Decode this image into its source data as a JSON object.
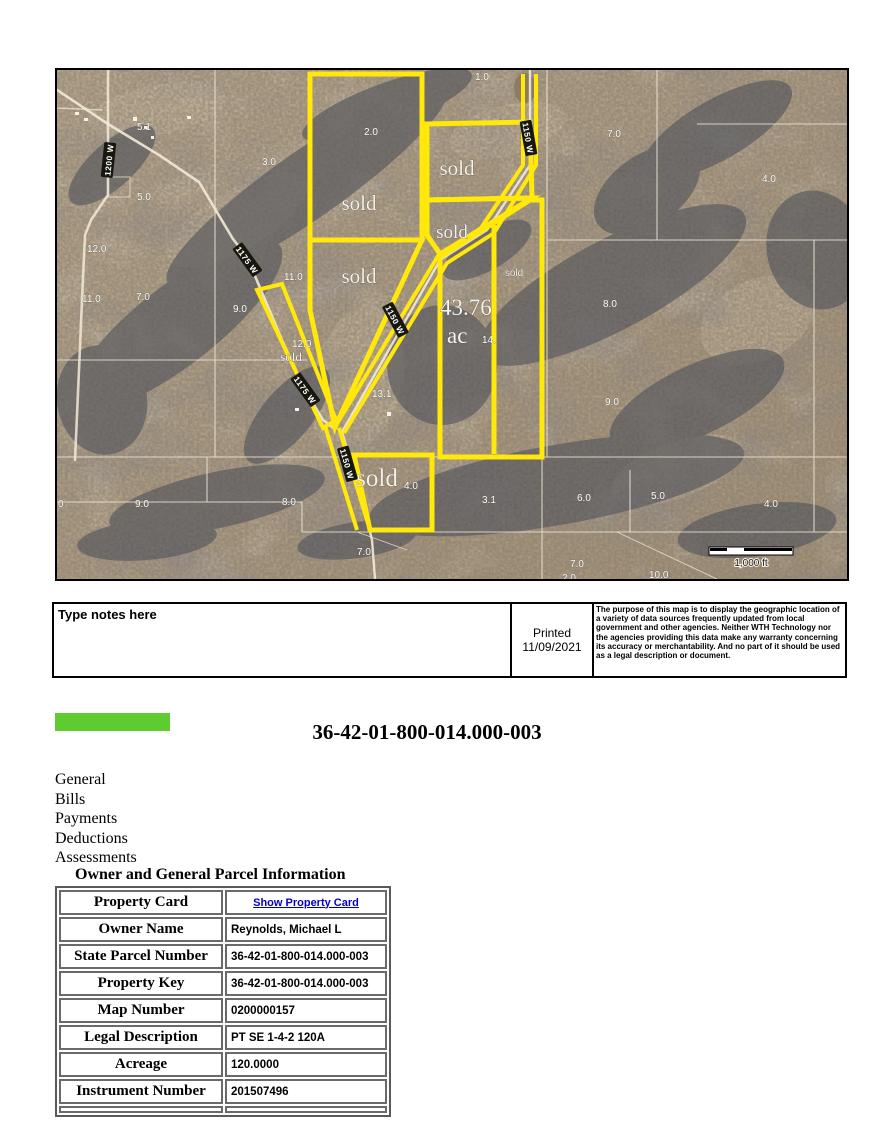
{
  "header": {
    "parcel_title": "36-42-01-800-014.000-003",
    "accent_color": "#5ecb31"
  },
  "notes": {
    "placeholder": "Type notes here",
    "printed_line1": "Printed",
    "printed_line2": "11/09/2021",
    "disclaimer": "The purpose of this map is to display the geographic location of a variety of data sources frequently updated from local government and other agencies. Neither WTH Technology nor the agencies providing this data make any warranty concerning its accuracy or merchantability. And no part of it should be used as a legal description or document."
  },
  "nav": {
    "items": [
      "General",
      "Bills",
      "Payments",
      "Deductions",
      "Assessments"
    ]
  },
  "section": {
    "heading": "Owner and General Parcel Information"
  },
  "parcel_table": {
    "rows": [
      {
        "label": "Property Card",
        "value": "Show Property Card",
        "link": true
      },
      {
        "label": "Owner Name",
        "value": "Reynolds, Michael L"
      },
      {
        "label": "State Parcel Number",
        "value": "36-42-01-800-014.000-003"
      },
      {
        "label": "Property Key",
        "value": "36-42-01-800-014.000-003"
      },
      {
        "label": "Map Number",
        "value": "0200000157"
      },
      {
        "label": "Legal Description",
        "value": "PT SE 1-4-2 120A"
      },
      {
        "label": "Acreage",
        "value": "120.0000"
      },
      {
        "label": "Instrument Number",
        "value": "201507496"
      }
    ]
  },
  "map": {
    "boundary_color": "#ffe80a",
    "scale_label": "1,000 ft",
    "big_parcel": {
      "line1": "43.76",
      "line2": "ac"
    },
    "area_labels": [
      {
        "t": "5.1",
        "x": 80,
        "y": 60
      },
      {
        "t": "1.0",
        "x": 418,
        "y": 10
      },
      {
        "t": "3.0",
        "x": 205,
        "y": 95
      },
      {
        "t": "2.0",
        "x": 307,
        "y": 65
      },
      {
        "t": "5.0",
        "x": 80,
        "y": 130
      },
      {
        "t": "12.0",
        "x": 30,
        "y": 182
      },
      {
        "t": "11.0",
        "x": 25,
        "y": 232
      },
      {
        "t": "7.0",
        "x": 79,
        "y": 230
      },
      {
        "t": "9.0",
        "x": 176,
        "y": 242
      },
      {
        "t": "11.0",
        "x": 227,
        "y": 210
      },
      {
        "t": "7.0",
        "x": 550,
        "y": 67
      },
      {
        "t": "4.0",
        "x": 705,
        "y": 112
      },
      {
        "t": "8.0",
        "x": 546,
        "y": 237
      },
      {
        "t": "12.0",
        "x": 235,
        "y": 277
      },
      {
        "t": "13.1",
        "x": 315,
        "y": 327
      },
      {
        "t": "14.",
        "x": 425,
        "y": 273
      },
      {
        "t": "9.0",
        "x": 548,
        "y": 335
      },
      {
        "t": "0",
        "x": 1,
        "y": 437
      },
      {
        "t": "9.0",
        "x": 78,
        "y": 437
      },
      {
        "t": "8.0",
        "x": 225,
        "y": 435
      },
      {
        "t": "6.0",
        "x": 520,
        "y": 431
      },
      {
        "t": "5.0",
        "x": 594,
        "y": 429
      },
      {
        "t": "4.0",
        "x": 707,
        "y": 437
      },
      {
        "t": "3.1",
        "x": 425,
        "y": 433
      },
      {
        "t": "4.0",
        "x": 347,
        "y": 419
      },
      {
        "t": "7.0",
        "x": 300,
        "y": 485
      },
      {
        "t": "7.0",
        "x": 513,
        "y": 497
      },
      {
        "t": "10.0",
        "x": 592,
        "y": 508
      },
      {
        "t": "2.0",
        "x": 505,
        "y": 511
      }
    ],
    "sold_labels": [
      {
        "t": "sold",
        "x": 302,
        "y": 140,
        "s": 21
      },
      {
        "t": "sold",
        "x": 400,
        "y": 105,
        "s": 21
      },
      {
        "t": "sold",
        "x": 395,
        "y": 168,
        "s": 19
      },
      {
        "t": "sold",
        "x": 302,
        "y": 213,
        "s": 21
      },
      {
        "t": "sold",
        "x": 234,
        "y": 291,
        "s": 13
      },
      {
        "t": "sold",
        "x": 457,
        "y": 206,
        "s": 10,
        "f": "sans"
      },
      {
        "t": "sold",
        "x": 320,
        "y": 416,
        "s": 25
      }
    ],
    "road_labels": [
      {
        "t": "1200 W",
        "x": 52,
        "y": 90,
        "r": -84
      },
      {
        "t": "1175 W",
        "x": 190,
        "y": 190,
        "r": 54
      },
      {
        "t": "1175 W",
        "x": 248,
        "y": 320,
        "r": 54
      },
      {
        "t": "1150 W",
        "x": 338,
        "y": 250,
        "r": 62
      },
      {
        "t": "1150 W",
        "x": 290,
        "y": 394,
        "r": 74
      },
      {
        "t": "1150 W",
        "x": 471,
        "y": 68,
        "r": 80
      }
    ]
  }
}
